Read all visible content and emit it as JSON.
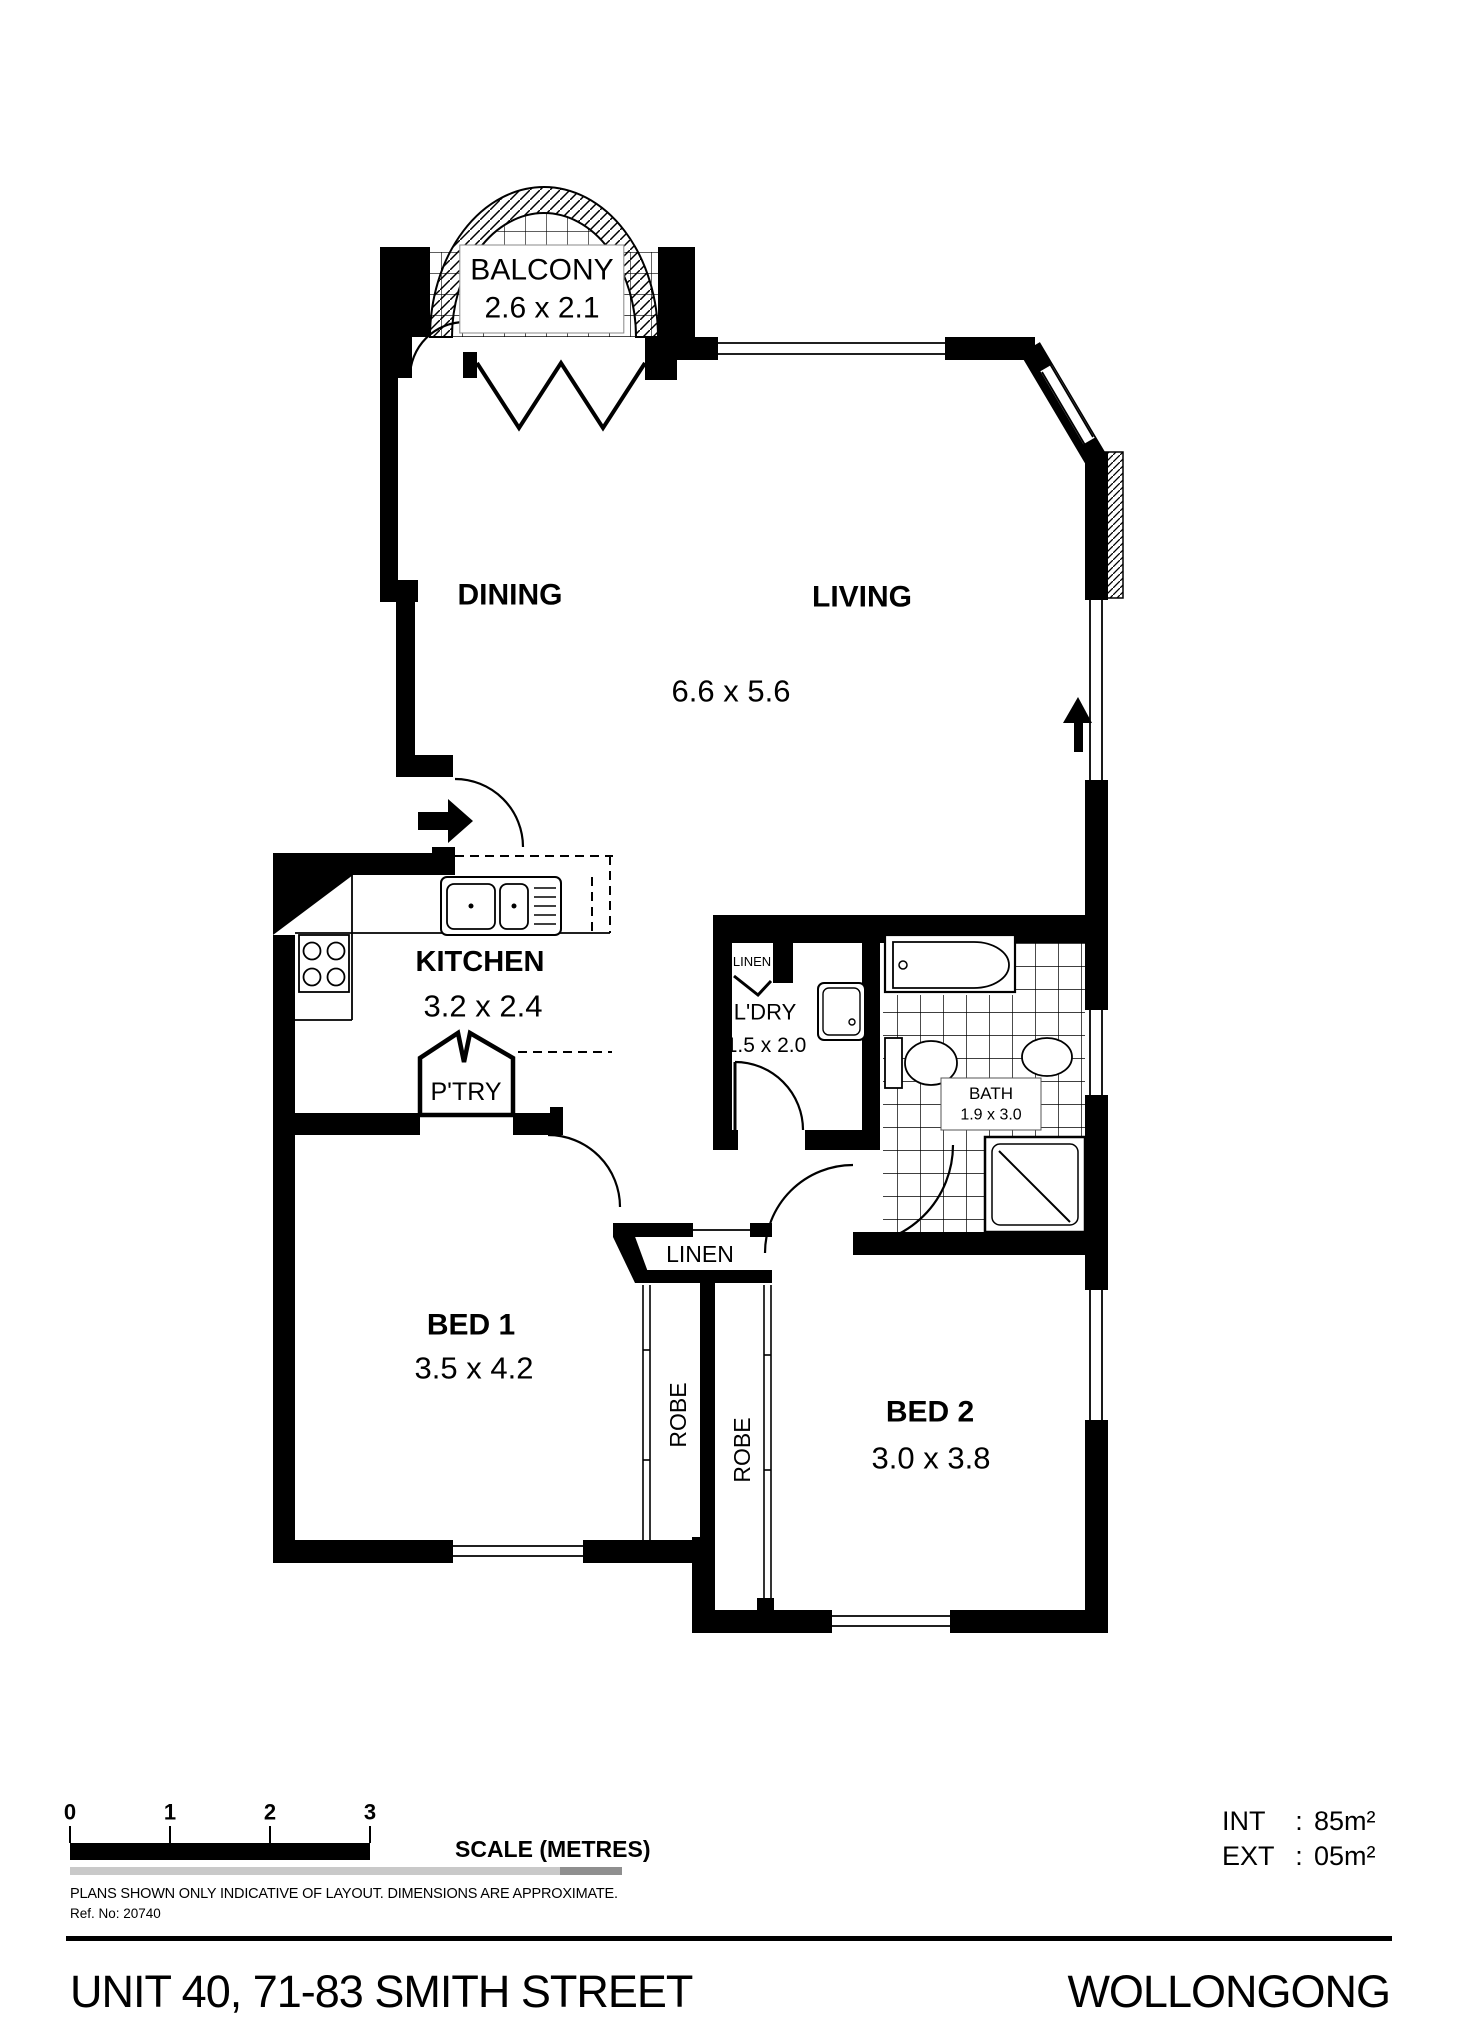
{
  "floorplan": {
    "balcony": {
      "name": "BALCONY",
      "dim": "2.6 x 2.1"
    },
    "dining": {
      "name": "DINING"
    },
    "living": {
      "name": "LIVING"
    },
    "living_dim": "6.6 x 5.6",
    "kitchen": {
      "name": "KITCHEN",
      "dim": "3.2 x 2.4"
    },
    "pantry": {
      "name": "P'TRY"
    },
    "linen_a": {
      "name": "LINEN"
    },
    "laundry": {
      "name": "L'DRY",
      "dim": "1.5 x 2.0"
    },
    "bath": {
      "name": "BATH",
      "dim": "1.9 x 3.0"
    },
    "linen_b": {
      "name": "LINEN"
    },
    "bed1": {
      "name": "BED 1",
      "dim": "3.5 x 4.2"
    },
    "robe1": {
      "name": "ROBE"
    },
    "robe2": {
      "name": "ROBE"
    },
    "bed2": {
      "name": "BED 2",
      "dim": "3.0 x 3.8"
    }
  },
  "scale_bar": {
    "ticks": [
      "0",
      "1",
      "2",
      "3"
    ],
    "label": "SCALE (METRES)"
  },
  "areas": {
    "int_label": "INT",
    "int_value": "85m²",
    "ext_label": "EXT",
    "ext_value": "05m²",
    "separator": ":"
  },
  "footer": {
    "disclaimer": "PLANS SHOWN ONLY INDICATIVE OF LAYOUT.  DIMENSIONS ARE APPROXIMATE.",
    "ref": "Ref. No: 20740",
    "address": "UNIT 40, 71-83 SMITH STREET",
    "city": "WOLLONGONG"
  }
}
